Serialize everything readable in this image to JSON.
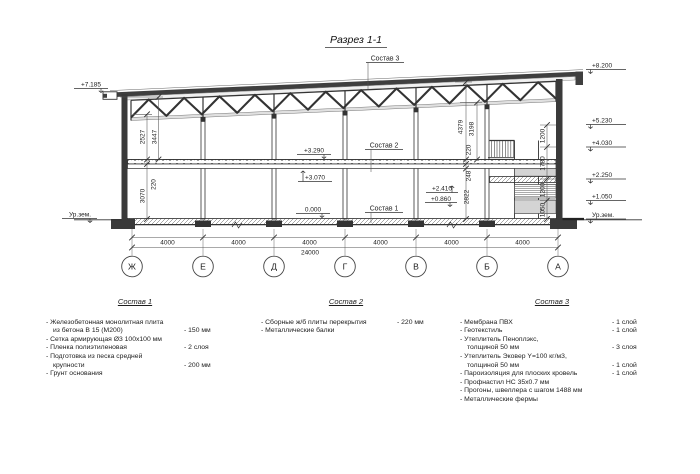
{
  "drawing_title": "Разрез 1-1",
  "section": {
    "callouts": {
      "c1": "Состав 1",
      "c2": "Состав 2",
      "c3": "Состав 3"
    },
    "elevations": {
      "left_roof": "+7.185",
      "left_ground": "Ур.зем.",
      "right": [
        "+8.200",
        "+5.230",
        "+4.030",
        "+2.250",
        "+1.050",
        "Ур.зем."
      ],
      "slab_top": "+3.290",
      "slab_bottom": "+3.070",
      "stair_upper": "+2.410",
      "stair_lower": "+0.860",
      "floor_zero": "0.000"
    },
    "dims": {
      "left": [
        "2527",
        "3447",
        "220",
        "3070"
      ],
      "right": [
        "4379",
        "3198",
        "220",
        "248",
        "2822"
      ],
      "stair": [
        "1200",
        "1780",
        "1200",
        "1050"
      ],
      "spans": [
        "4000",
        "4000",
        "4000",
        "4000",
        "4000",
        "4000"
      ],
      "total": "24000"
    },
    "axes": [
      "Ж",
      "Е",
      "Д",
      "Г",
      "В",
      "Б",
      "А"
    ]
  },
  "compositions": [
    {
      "title": "Состав 1",
      "items": [
        {
          "l1": "- Железобетонная  монолитная плита",
          "l2": "из бетона В 15 (М200)",
          "v": "- 150 мм"
        },
        {
          "l1": "- Сетка армирующая Ø3 100х100 мм",
          "v": ""
        },
        {
          "l1": "- Пленка полиэтиленовая",
          "v": "- 2 слоя"
        },
        {
          "l1": "- Подготовка из песка средней",
          "l2": "крупности",
          "v": "- 200 мм"
        },
        {
          "l1": "- Грунт основания",
          "v": ""
        }
      ]
    },
    {
      "title": "Состав 2",
      "items": [
        {
          "l1": "- Сборные ж/б плиты перекрытия",
          "v": "- 220 мм"
        },
        {
          "l1": "- Металлические балки",
          "v": ""
        }
      ]
    },
    {
      "title": "Состав 3",
      "items": [
        {
          "l1": "- Мембрана ПВХ",
          "v": "- 1 слой"
        },
        {
          "l1": "- Геотекстиль",
          "v": "- 1 слой"
        },
        {
          "l1": "- Утеплитель Пеноплэкс,",
          "l2": "толщиной 50 мм",
          "v": "- 3 слоя"
        },
        {
          "l1": "- Утеплитель Эковер Y=100 кг/м3,",
          "l2": "толщиной 50 мм",
          "v": "- 1 слой"
        },
        {
          "l1": "- Пароизоляция для плоских кровель",
          "v": "- 1 слой"
        },
        {
          "l1": "- Профнастил НС 35х0.7 мм",
          "v": ""
        },
        {
          "l1": "- Прогоны, швеллера с шагом 1488 мм",
          "v": ""
        },
        {
          "l1": "- Металлические фермы",
          "v": ""
        }
      ]
    }
  ]
}
